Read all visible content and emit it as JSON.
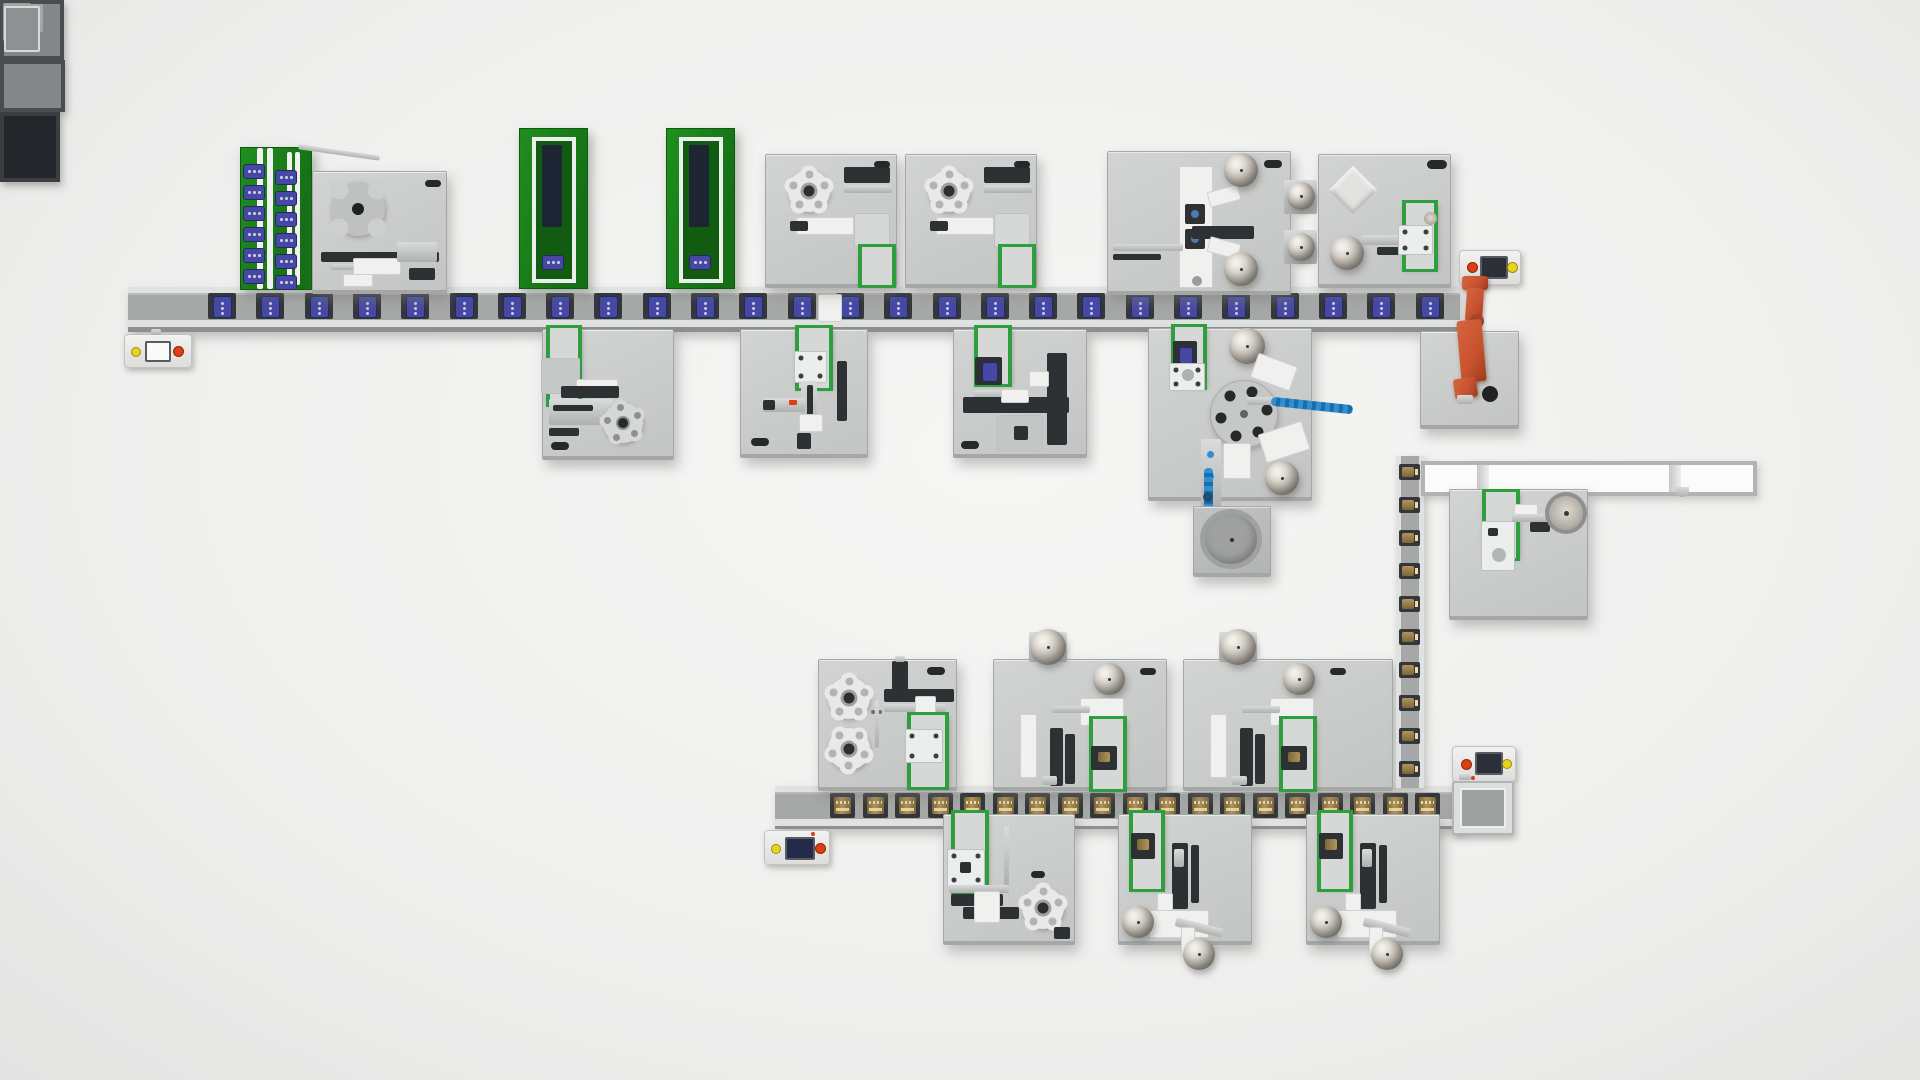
{
  "palette": {
    "bg1": "#f6f6f5",
    "bg2": "#efefee",
    "bg3": "#e4e4e3",
    "pf1": "#d2d4d3",
    "pf2": "#c3c5c4",
    "pfEdge": "#a5a7a6",
    "railHi": "#e0e2e1",
    "railEdge": "#b8bab9",
    "belt": "#a6a8a7",
    "railSh": "#8e908f",
    "pallet": "#33363a",
    "blue": "#4549a3",
    "blueDk": "#26285f",
    "blueLt": "#c9cbe4",
    "gold": "#b3945a",
    "goldDk": "#7c6638",
    "goldLt": "#ecdcab",
    "green": "#2f9e3f",
    "greenDk": "#157015",
    "magGreen": "#1f8f1f",
    "dark": "#2e3133",
    "liftBed": "#d6d8d7",
    "metalHi": "#f2f0ec",
    "metalLo": "#5e5a52",
    "orange": "#c8512e",
    "orangeDk": "#9c3a1e",
    "btnRed": "#da3f16",
    "btnYel": "#e8d41c",
    "screen": "#2b2f37",
    "screenBlue": "#232a4a",
    "blueTrack": "#2e8fd4"
  },
  "conveyors": {
    "top": {
      "pallets": 26,
      "pitch": 48.3,
      "start": 80,
      "css": "pb"
    },
    "bottom": {
      "pallets": 19,
      "pitch": 32.5,
      "start": 55,
      "css": "pg"
    },
    "vertical": {
      "pallets": 10,
      "pitch": 33,
      "start": 8,
      "css": "pv",
      "dir": "v"
    }
  },
  "magazines": {
    "items_per_column": 6,
    "item_pitch": 21
  },
  "components": [
    "pallet-infeed-elevator",
    "hmi-terminal",
    "magazine-tower",
    "rotary-index-station",
    "assembly-station",
    "bowl-feeder-station",
    "vision-feeder-station",
    "scara-robot",
    "dial-table-station",
    "bowl-feeder",
    "transfer-conveyor",
    "sphere-feeder-station",
    "disc-magazine-station",
    "output-elevator",
    "vertical-link-conveyor",
    "overhead-beam-gantry"
  ]
}
